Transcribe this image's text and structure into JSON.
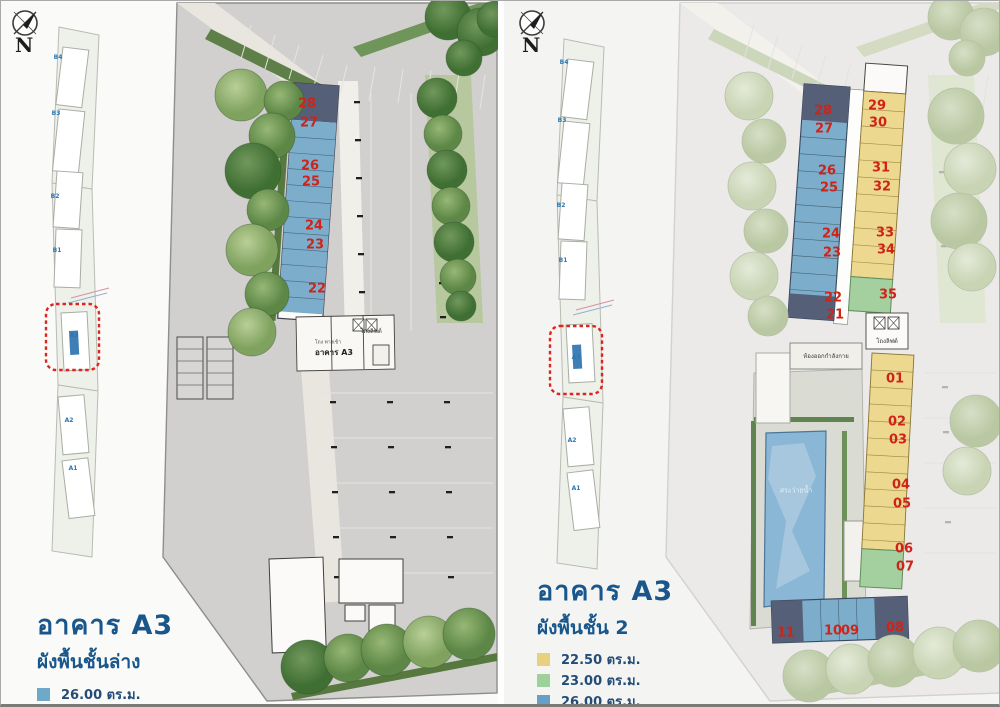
{
  "colors": {
    "unit_blue": "#7cadca",
    "unit_dark_slate": "#555f78",
    "unit_yellow": "#ecd88f",
    "unit_green": "#a4cf9e",
    "unit_number_red": "#cf2318",
    "title_blue": "#19568b",
    "highlight_box_red": "#e0241c",
    "pool_blue": "#8ab7d6"
  },
  "panels": [
    {
      "title": "อาคาร A3",
      "subtitle": "ผังพื้นชั้นล่าง",
      "compass_letter": "N",
      "legend": [
        {
          "color": "#6fa9c9",
          "label": "26.00 ตร.ม."
        },
        {
          "color": "#55607a",
          "label": "26.50 ตร.ม."
        }
      ],
      "minimap": {
        "highlighted_building": "A3",
        "labels": [
          {
            "t": "B4",
            "x": 57,
            "y": 57
          },
          {
            "t": "B3",
            "x": 55,
            "y": 113
          },
          {
            "t": "B2",
            "x": 54,
            "y": 196
          },
          {
            "t": "B1",
            "x": 56,
            "y": 250
          },
          {
            "t": "A3",
            "x": 73,
            "y": 335
          },
          {
            "t": "A2",
            "x": 68,
            "y": 420
          },
          {
            "t": "A1",
            "x": 72,
            "y": 468
          }
        ]
      },
      "units": [
        {
          "no": "28",
          "x": 306,
          "y": 103
        },
        {
          "no": "27",
          "x": 308,
          "y": 122
        },
        {
          "no": "26",
          "x": 309,
          "y": 165
        },
        {
          "no": "25",
          "x": 310,
          "y": 181
        },
        {
          "no": "24",
          "x": 313,
          "y": 225
        },
        {
          "no": "23",
          "x": 314,
          "y": 244
        },
        {
          "no": "22",
          "x": 316,
          "y": 288
        }
      ],
      "plan_labels": [
        {
          "t": "โถงลิฟต์",
          "x": 370,
          "y": 331,
          "s": 6,
          "c": "#33332f",
          "b": false
        },
        {
          "t": "โถง ทางเข้า",
          "x": 327,
          "y": 342,
          "s": 5,
          "c": "#4a4a46",
          "b": false
        },
        {
          "t": "อาคาร A3",
          "x": 333,
          "y": 352,
          "s": 8,
          "c": "#222220",
          "b": true
        }
      ]
    },
    {
      "title": "อาคาร A3",
      "subtitle": "ผังพื้นชั้น 2",
      "compass_letter": "N",
      "legend": [
        {
          "color": "#e9d07e",
          "label": "22.50 ตร.ม."
        },
        {
          "color": "#9ed09c",
          "label": "23.00 ตร.ม."
        },
        {
          "color": "#689fc4",
          "label": "26.00 ตร.ม."
        },
        {
          "color": "#55607a",
          "label": "26.50 ตร.ม."
        }
      ],
      "minimap": {
        "highlighted_building": "A3",
        "labels": [
          {
            "t": "B4",
            "x": 60,
            "y": 62
          },
          {
            "t": "B3",
            "x": 58,
            "y": 120
          },
          {
            "t": "B2",
            "x": 57,
            "y": 205
          },
          {
            "t": "B1",
            "x": 59,
            "y": 260
          },
          {
            "t": "A3",
            "x": 72,
            "y": 357
          },
          {
            "t": "A2",
            "x": 68,
            "y": 440
          },
          {
            "t": "A1",
            "x": 72,
            "y": 488
          }
        ]
      },
      "units": [
        {
          "no": "28",
          "x": 319,
          "y": 110
        },
        {
          "no": "27",
          "x": 320,
          "y": 128
        },
        {
          "no": "26",
          "x": 323,
          "y": 170
        },
        {
          "no": "25",
          "x": 325,
          "y": 187
        },
        {
          "no": "24",
          "x": 327,
          "y": 233
        },
        {
          "no": "23",
          "x": 328,
          "y": 252
        },
        {
          "no": "22",
          "x": 329,
          "y": 297
        },
        {
          "no": "21",
          "x": 331,
          "y": 314
        },
        {
          "no": "29",
          "x": 373,
          "y": 105
        },
        {
          "no": "30",
          "x": 374,
          "y": 122
        },
        {
          "no": "31",
          "x": 377,
          "y": 167
        },
        {
          "no": "32",
          "x": 378,
          "y": 186
        },
        {
          "no": "33",
          "x": 381,
          "y": 232
        },
        {
          "no": "34",
          "x": 382,
          "y": 249
        },
        {
          "no": "35",
          "x": 384,
          "y": 294
        },
        {
          "no": "01",
          "x": 391,
          "y": 378
        },
        {
          "no": "02",
          "x": 393,
          "y": 421
        },
        {
          "no": "03",
          "x": 394,
          "y": 439
        },
        {
          "no": "04",
          "x": 397,
          "y": 484
        },
        {
          "no": "05",
          "x": 398,
          "y": 503
        },
        {
          "no": "06",
          "x": 400,
          "y": 548
        },
        {
          "no": "07",
          "x": 401,
          "y": 566
        },
        {
          "no": "11",
          "x": 282,
          "y": 632
        },
        {
          "no": "10",
          "x": 329,
          "y": 630
        },
        {
          "no": "09",
          "x": 346,
          "y": 630
        },
        {
          "no": "08",
          "x": 391,
          "y": 627
        }
      ],
      "plan_labels": [
        {
          "t": "ห้องออกกำลังกาย",
          "x": 322,
          "y": 356,
          "s": 6,
          "c": "#3a3a36",
          "b": false
        },
        {
          "t": "โถงลิฟต์",
          "x": 383,
          "y": 341,
          "s": 6,
          "c": "#33332f",
          "b": false
        },
        {
          "t": "สระว่ายน้ำ",
          "x": 292,
          "y": 490,
          "s": 7,
          "c": "#e8f1f6",
          "b": false
        }
      ]
    }
  ]
}
